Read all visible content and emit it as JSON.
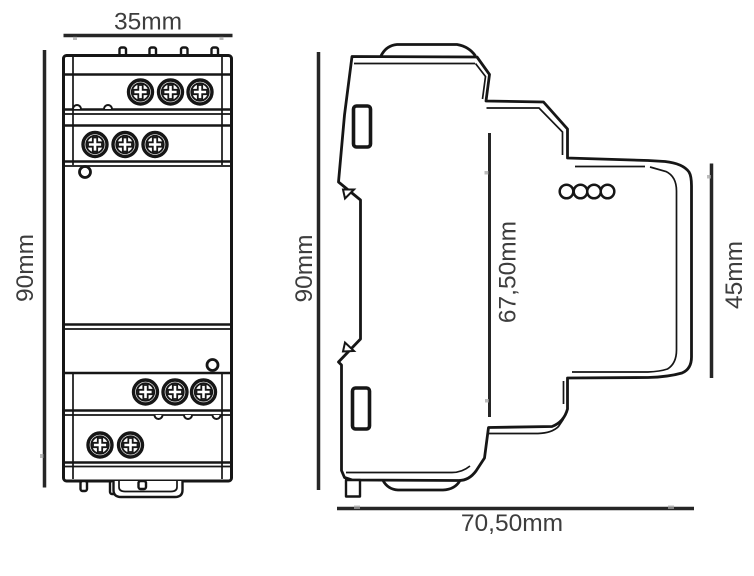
{
  "diagram": {
    "front_view": {
      "width_label": "35mm",
      "height_label": "90mm"
    },
    "side_view": {
      "height_label": "90mm",
      "inner_height_label": "67,50mm",
      "front_height_label": "45mm",
      "depth_label": "70,50mm"
    },
    "colors": {
      "background": "#ffffff",
      "outline": "#161616",
      "dimension_line": "#262626",
      "label_text": "#3d3d3d"
    }
  }
}
